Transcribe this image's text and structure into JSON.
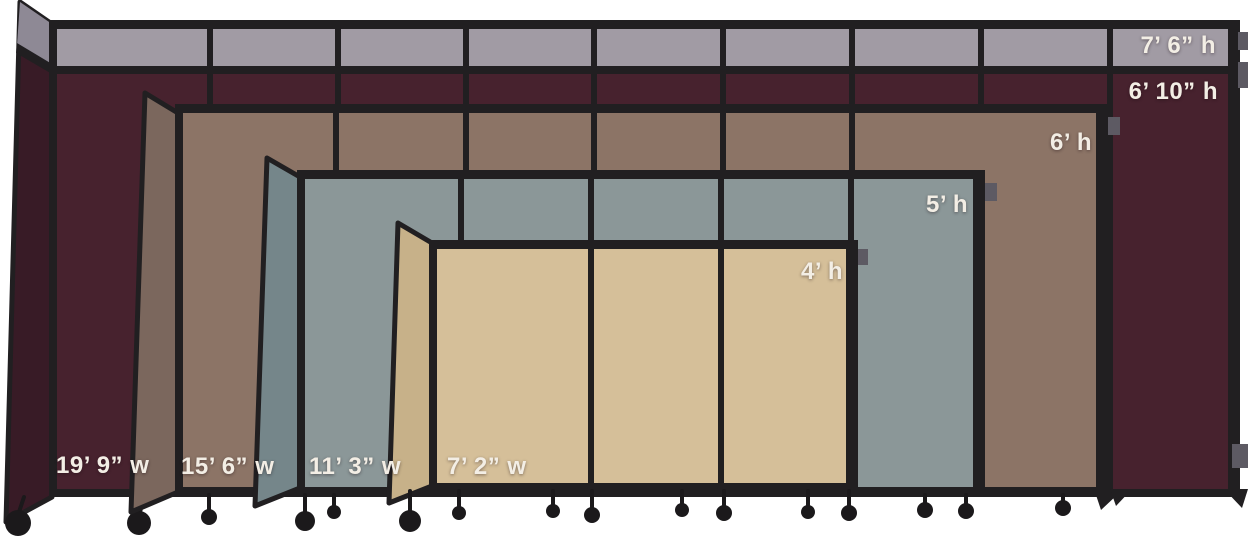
{
  "colors": {
    "background": "#ffffff",
    "frame": "#211f21",
    "label_text": "#f3eee5",
    "top_cap_gray": "#a19ba4",
    "top_cap_gray_dark": "#8e8995",
    "bracket_gray": "#5d5a63"
  },
  "dividers": [
    {
      "fabric": "burgundy",
      "cap_height_label": "7’ 6” h",
      "height_label": "6’ 10” h",
      "width_label": "19’ 9” w",
      "fabric_color": "#47222e",
      "fabric_color_dark": "#381b26"
    },
    {
      "fabric": "brown",
      "height_label": "6’ h",
      "width_label": "15’ 6” w",
      "fabric_color": "#8c7466",
      "fabric_color_dark": "#7b675d"
    },
    {
      "fabric": "blue-gray",
      "height_label": "5’ h",
      "width_label": "11’ 3” w",
      "fabric_color": "#8b9798",
      "fabric_color_dark": "#75868a"
    },
    {
      "fabric": "beige",
      "height_label": "4’ h",
      "width_label": "7’ 2” w",
      "fabric_color": "#d5bf99",
      "fabric_color_dark": "#c7b189"
    }
  ]
}
